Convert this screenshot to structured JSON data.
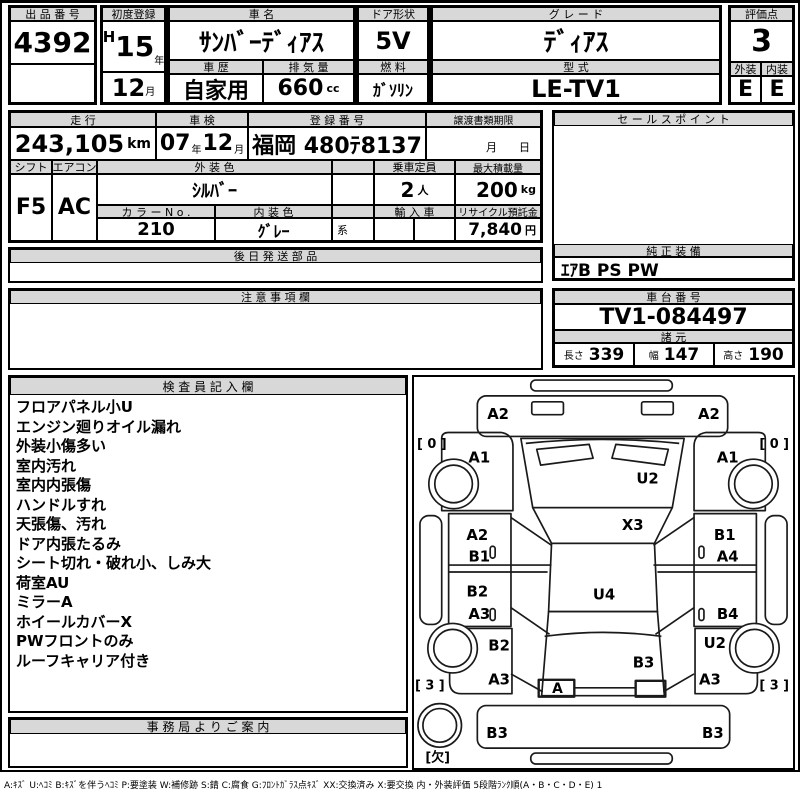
{
  "top": {
    "auction_no": {
      "label": "出 品 番 号",
      "value": "4392"
    },
    "first_reg": {
      "label": "初度登録",
      "era": "H",
      "year": "15",
      "year_unit": "年",
      "month": "12",
      "month_unit": "月"
    },
    "car_name": {
      "label": "車 名",
      "value": "ｻﾝﾊﾞｰﾃﾞｨｱｽ"
    },
    "door": {
      "label": "ドア形状",
      "value": "5V"
    },
    "grade": {
      "label": "グ レ ー ド",
      "value": "ﾃﾞｨｱｽ"
    },
    "score": {
      "label": "評価点",
      "value": "3"
    },
    "history": {
      "label": "車 歴",
      "value": "自家用"
    },
    "displacement": {
      "label": "排 気 量",
      "value": "660",
      "unit": "cc"
    },
    "fuel": {
      "label": "燃 料",
      "value": "ｶﾞｿﾘﾝ"
    },
    "model_code": {
      "label": "型 式",
      "value": "LE-TV1"
    },
    "exterior": {
      "label": "外装",
      "value": "E"
    },
    "interior": {
      "label": "内装",
      "value": "E"
    }
  },
  "info": {
    "mileage": {
      "label": "走 行",
      "value": "243,105",
      "unit": "km"
    },
    "shaken": {
      "label": "車 検",
      "year": "07",
      "year_unit": "年",
      "month": "12",
      "month_unit": "月"
    },
    "reg_no": {
      "label": "登 録 番 号",
      "value": "福岡 480ﾃ8137"
    },
    "transfer_deadline": {
      "label": "譲渡書類期限",
      "month_label": "月",
      "day_label": "日"
    },
    "shift": {
      "label": "シフト",
      "value": "F5"
    },
    "aircon": {
      "label": "エアコン",
      "value": "AC"
    },
    "ext_color": {
      "label": "外 装 色",
      "value": "ｼﾙﾊﾞｰ"
    },
    "capacity": {
      "label": "乗車定員",
      "value": "2",
      "unit": "人"
    },
    "max_load": {
      "label": "最大積載量",
      "value": "200",
      "unit": "kg"
    },
    "color_no": {
      "label": "カ ラ ー N o .",
      "value": "210"
    },
    "int_color": {
      "label": "内 装 色",
      "value": "ｸﾞﾚｰ",
      "suffix": "系"
    },
    "imported": {
      "label": "輸 入 車",
      "value": ""
    },
    "recycle_deposit": {
      "label": "リサイクル預託金",
      "value": "7,840",
      "unit": "円"
    }
  },
  "sections": {
    "later_parts": {
      "label": "後 日 発 送 部 品",
      "content": ""
    },
    "caution": {
      "label": "注 意 事 項 欄",
      "content": ""
    },
    "sales_point": {
      "label": "セ ー ル ス ポ イ ン ト",
      "content": ""
    },
    "genuine_equipment": {
      "label": "純 正 装 備",
      "value": "ｴｱB PS PW"
    },
    "chassis_no": {
      "label": "車 台 番 号",
      "value": "TV1-084497"
    },
    "dimensions": {
      "label": "諸 元",
      "length_label": "長さ",
      "length": "339",
      "width_label": "幅",
      "width": "147",
      "height_label": "高さ",
      "height": "190"
    },
    "inspector": {
      "label": "検 査 員 記 入 欄",
      "lines": [
        "フロアパネル小U",
        "エンジン廻りオイル漏れ",
        "外装小傷多い",
        "室内汚れ",
        "室内内張傷",
        "ハンドルすれ",
        "天張傷、汚れ",
        "ドア内張たるみ",
        "シート切れ・破れ小、しみ大",
        "荷室AU",
        "ミラーA",
        "ホイールカバーX",
        "PWフロントのみ",
        "ルーフキャリア付き"
      ]
    },
    "office_notice": {
      "label": "事 務 局 よ り ご 案 内",
      "content": ""
    }
  },
  "diagram": {
    "labels": [
      {
        "text": "A2",
        "x": 85,
        "y": 38
      },
      {
        "text": "A2",
        "x": 298,
        "y": 38
      },
      {
        "text": "[ 0 ]",
        "x": 18,
        "y": 68,
        "size": 13
      },
      {
        "text": "[ 0 ]",
        "x": 364,
        "y": 68,
        "size": 13
      },
      {
        "text": "A1",
        "x": 66,
        "y": 82
      },
      {
        "text": "A1",
        "x": 317,
        "y": 82
      },
      {
        "text": "U2",
        "x": 236,
        "y": 103
      },
      {
        "text": "X3",
        "x": 221,
        "y": 150
      },
      {
        "text": "A2",
        "x": 64,
        "y": 160
      },
      {
        "text": "B1",
        "x": 66,
        "y": 182
      },
      {
        "text": "B1",
        "x": 314,
        "y": 160
      },
      {
        "text": "A4",
        "x": 317,
        "y": 182
      },
      {
        "text": "B2",
        "x": 64,
        "y": 217
      },
      {
        "text": "U4",
        "x": 192,
        "y": 220
      },
      {
        "text": "A3",
        "x": 66,
        "y": 240
      },
      {
        "text": "B4",
        "x": 317,
        "y": 240
      },
      {
        "text": "B2",
        "x": 86,
        "y": 272
      },
      {
        "text": "U2",
        "x": 304,
        "y": 269
      },
      {
        "text": "B3",
        "x": 232,
        "y": 289
      },
      {
        "text": "A3",
        "x": 86,
        "y": 306
      },
      {
        "text": "A3",
        "x": 299,
        "y": 306
      },
      {
        "text": "[ 3 ]",
        "x": 16,
        "y": 312,
        "size": 13
      },
      {
        "text": "[ 3 ]",
        "x": 364,
        "y": 312,
        "size": 13
      },
      {
        "text": "A",
        "x": 145,
        "y": 315,
        "size": 14
      },
      {
        "text": "B3",
        "x": 84,
        "y": 360
      },
      {
        "text": "B3",
        "x": 302,
        "y": 360
      },
      {
        "text": "[欠]",
        "x": 24,
        "y": 385,
        "size": 13
      }
    ]
  },
  "legend": "A:ｷｽﾞ U:ﾍｺﾐ B:ｷｽﾞを伴うﾍｺﾐ P:要塗装 W:補修跡 S:錆 C:腐食 G:ﾌﾛﾝﾄｶﾞﾗｽ点ｷｽﾞ XX:交換済み X:要交換  内・外装評価 5段階ﾗﾝｸ順(A・B・C・D・E) 1",
  "colors": {
    "header_bg": "#d8d8d8",
    "border": "#000000",
    "background": "#ffffff",
    "text": "#000000"
  }
}
